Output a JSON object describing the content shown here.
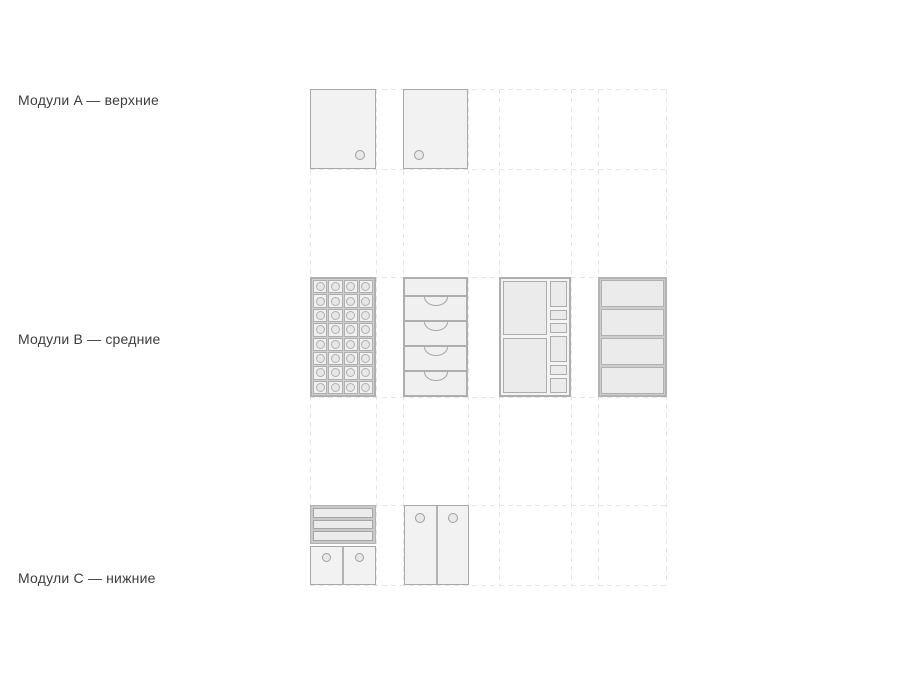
{
  "canvas": {
    "width": 900,
    "height": 675,
    "background": "#ffffff"
  },
  "rows": [
    {
      "id": "A",
      "label": "Модули A — верхние"
    },
    {
      "id": "B",
      "label": "Модули B — средние"
    },
    {
      "id": "C",
      "label": "Модули C — нижние"
    }
  ],
  "grid": {
    "column_bands": 4,
    "row_bands": 3,
    "line_style": "dashed"
  },
  "modules": {
    "a1": {
      "name": "wall-cabinet-handle-right",
      "handles": 1
    },
    "a2": {
      "name": "wall-cabinet-handle-left",
      "handles": 1
    },
    "b1": {
      "name": "wine-rack",
      "columns": 4,
      "rows": 8,
      "cells": 32
    },
    "b2": {
      "name": "drawer-stack",
      "drawers": 4
    },
    "b3": {
      "name": "compartment-unit",
      "large_cells": 2,
      "small_cells": 6
    },
    "b4": {
      "name": "open-shelf-unit",
      "shelves": 4
    },
    "c1": {
      "name": "base-cabinet-drawers-and-doors",
      "drawers": 3,
      "doors": 2
    },
    "c2": {
      "name": "base-cabinet-two-doors",
      "doors": 2
    }
  },
  "colors": {
    "background": "#ffffff",
    "module_fill": "#f2f2f2",
    "module_border": "#a9a9a9",
    "cell_fill": "#ebebeb",
    "cell_border": "#b0b0b0",
    "frame_gray": "#c9c9c9",
    "grid_dash": "#e6e6e6",
    "label_text": "#3d3d3d"
  }
}
